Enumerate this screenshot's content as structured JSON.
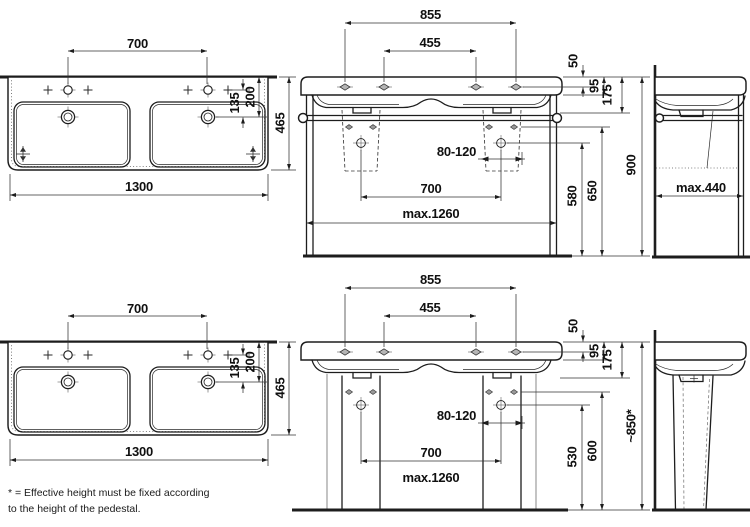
{
  "colors": {
    "line": "#1d1d1d",
    "text": "#101010",
    "background": "#ffffff"
  },
  "footnote": {
    "line1": "* = Effective height must be fixed according",
    "line2": "to the height of the pedestal."
  },
  "plan_top": {
    "tap_span": "700",
    "width": "1300",
    "tap_offset": "135",
    "drain_offset": "200",
    "depth": "465"
  },
  "front_top": {
    "outer_holes": "855",
    "inner_holes": "455",
    "edge_to_holes": "50",
    "apron_height": "95",
    "rail_drop": "175",
    "drain_play": "80-120",
    "drain_span": "700",
    "max_width": "max.1260",
    "drain_height": "580",
    "bracket_height": "650",
    "overall_height": "900"
  },
  "side_top": {
    "max_depth": "max.440"
  },
  "plan_bottom": {
    "tap_span": "700",
    "width": "1300",
    "tap_offset": "135",
    "drain_offset": "200",
    "depth": "465"
  },
  "front_bottom": {
    "outer_holes": "855",
    "inner_holes": "455",
    "edge_to_holes": "50",
    "apron_height": "95",
    "rail_drop": "175",
    "drain_play": "80-120",
    "drain_span": "700",
    "max_width": "max.1260",
    "drain_height": "530",
    "bracket_height": "600",
    "overall_height": "~850*"
  }
}
